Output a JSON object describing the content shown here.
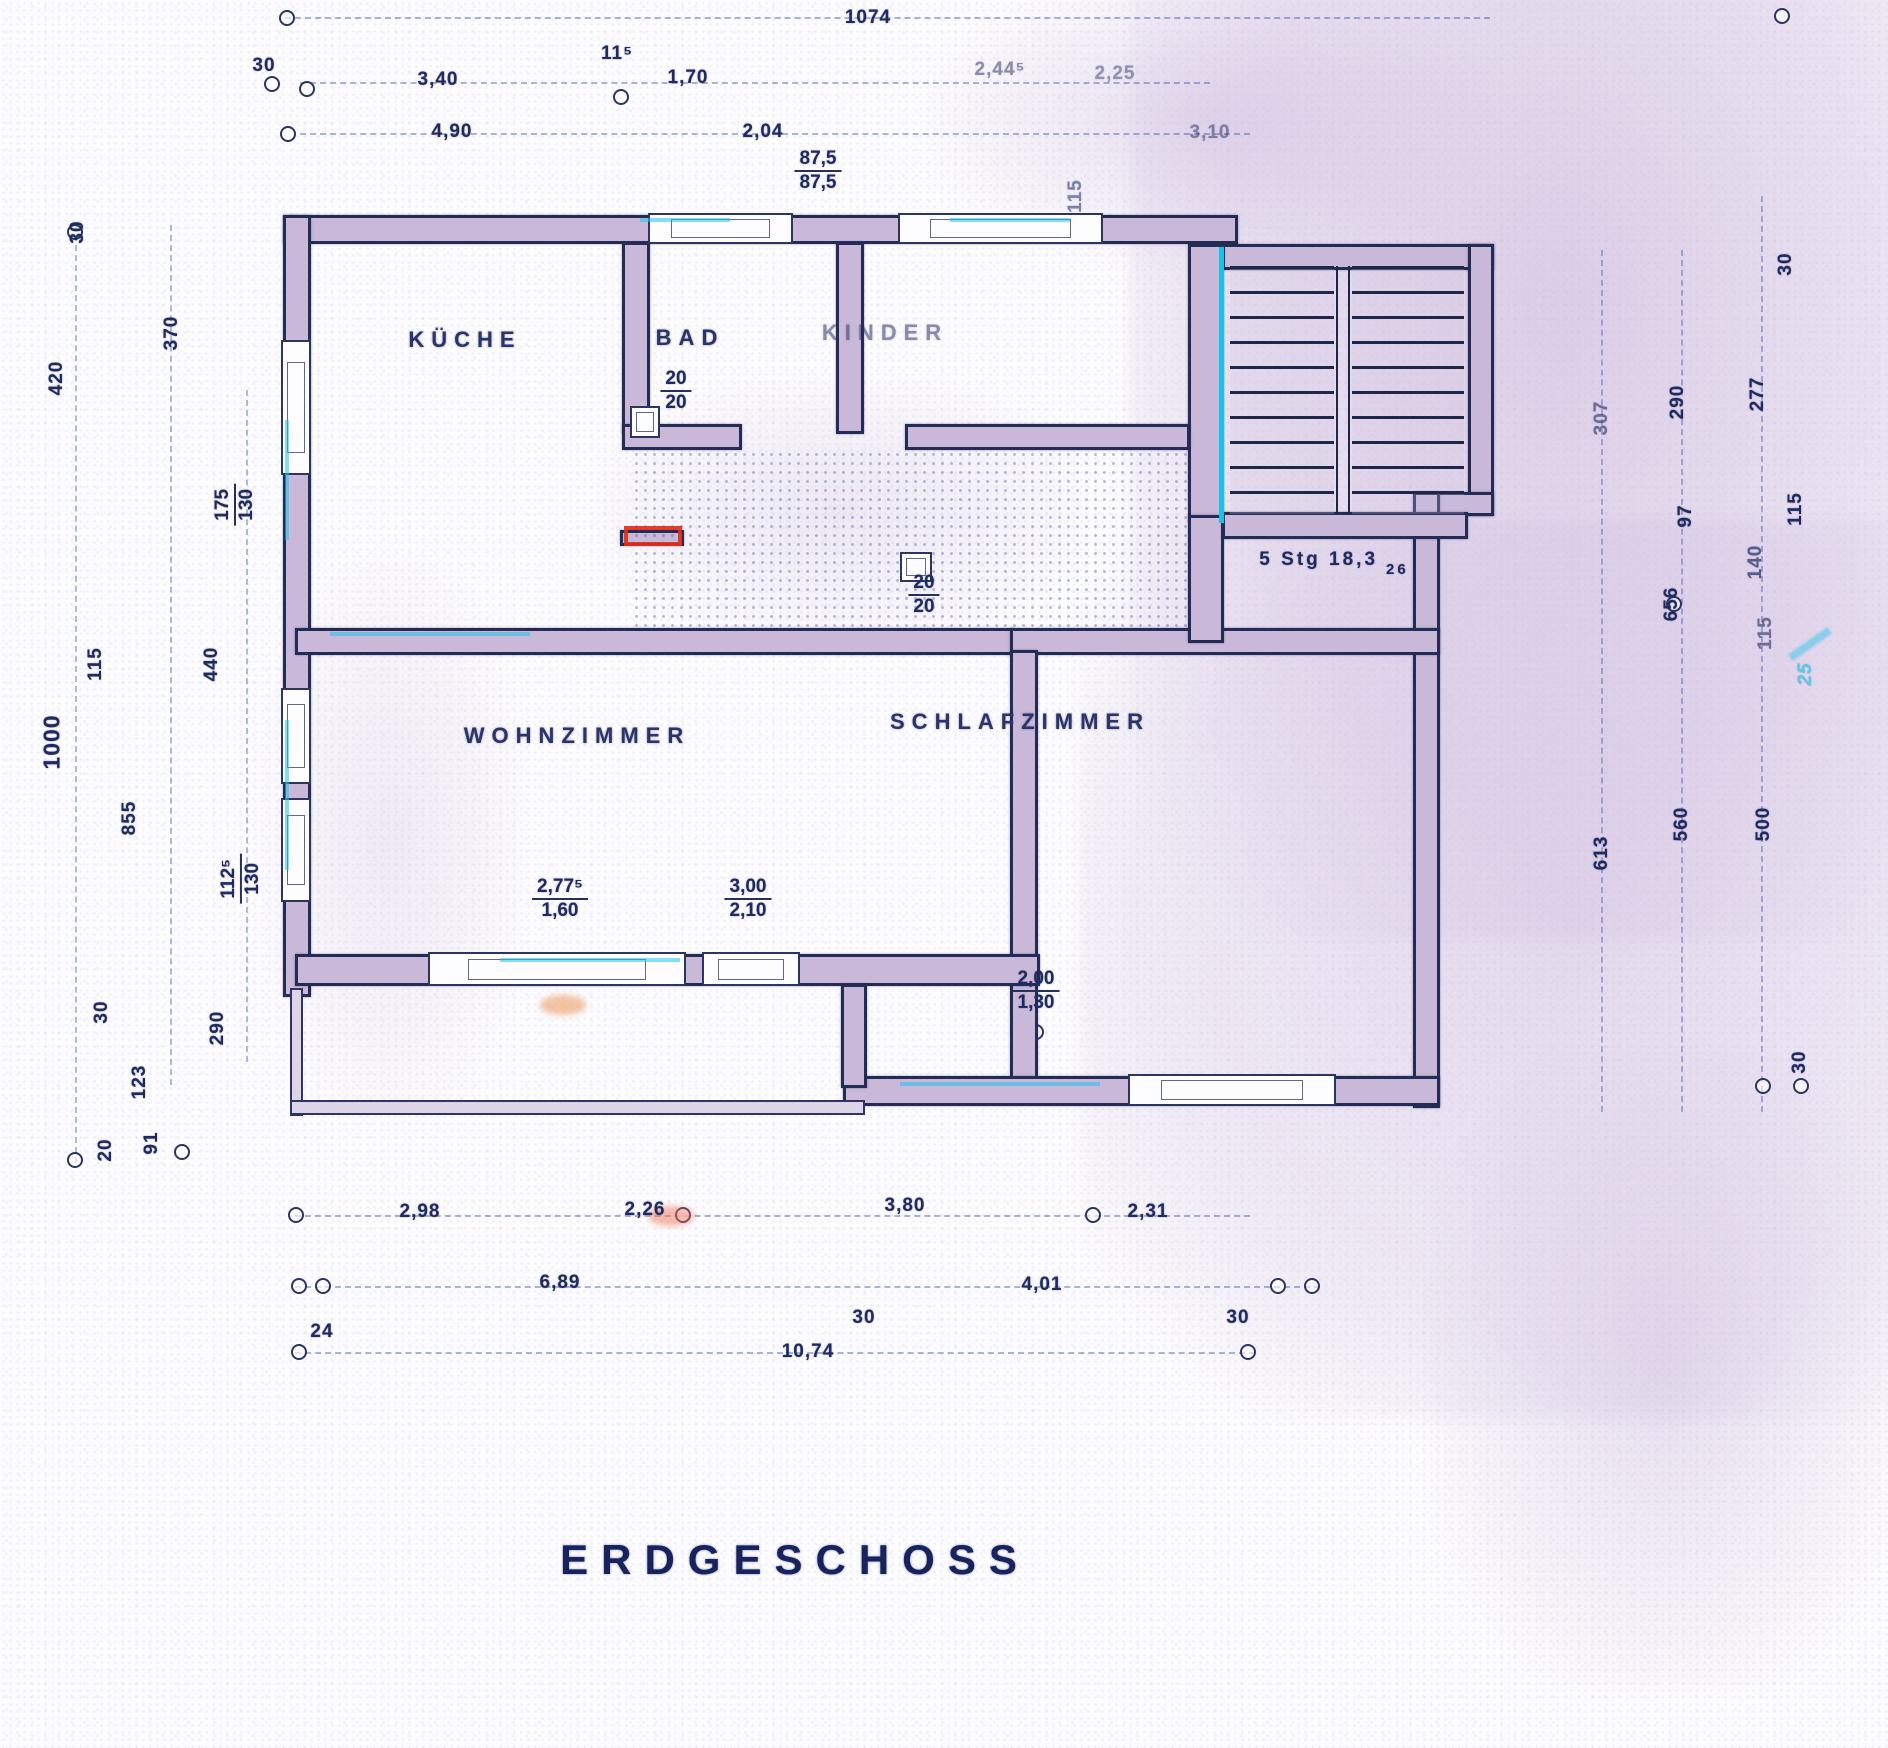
{
  "title": "ERDGESCHOSS",
  "rooms": {
    "kitchen": "KÜCHE",
    "bath": "BAD",
    "children": "KINDER",
    "living": "WOHNZIMMER",
    "bedroom": "SCHLAFZIMMER"
  },
  "stair": {
    "label": "5 Stg 18,3",
    "tread": "26"
  },
  "dims": {
    "top_total": "1074",
    "top_30": "30",
    "top_340": "3,40",
    "top_115": "11⁵",
    "top_170": "1,70",
    "top_2445": "2,44⁵",
    "top_225": "2,25",
    "top_490": "4,90",
    "top_204": "2,04",
    "top_310": "3,10",
    "bad_window_top": "87,5",
    "bad_window_bottom": "87,5",
    "axis_115": "115",
    "left_30": "30",
    "left_370": "370",
    "left_420": "420",
    "left_window1_top": "175",
    "left_window1_bottom": "130",
    "left_115": "115",
    "left_440": "440",
    "left_1000": "1000",
    "left_855": "855",
    "left_window2_top": "112⁵",
    "left_window2_bottom": "130",
    "left_bottom_30": "30",
    "left_290": "290",
    "left_123": "123",
    "left_20": "20",
    "left_91": "91",
    "right_top_30": "30",
    "right_307": "307",
    "right_290": "290",
    "right_277": "277",
    "right_97": "97",
    "right_115_upper": "115",
    "right_140": "140",
    "right_656": "656",
    "right_115_lower": "115",
    "right_25_note": "25",
    "right_560": "560",
    "right_500": "500",
    "right_613": "613",
    "right_bottom_30": "30",
    "door_bath_top": "20",
    "door_bath_bottom": "20",
    "door_bedroom_top": "20",
    "door_bedroom_bottom": "20",
    "terrace1_top": "2,77⁵",
    "terrace1_bottom": "1,60",
    "terrace2_top": "3,00",
    "terrace2_bottom": "2,10",
    "bedroom_window_top": "2,00",
    "bedroom_window_bottom": "1,30",
    "bottom_298": "2,98",
    "bottom_226": "2,26",
    "bottom_380": "3,80",
    "bottom_231": "2,31",
    "bottom_689": "6,89",
    "bottom_401": "4,01",
    "bottom_30_left": "30",
    "bottom_30_right": "30",
    "bottom_24": "24",
    "bottom_total": "10,74"
  },
  "colors": {
    "ink": "#1f2a5e",
    "wall_fill": "#c9b8d8",
    "cyan_accent": "#18c2e8",
    "red_marker": "#df2f1d",
    "scan_tint": "#d6c6e2"
  }
}
